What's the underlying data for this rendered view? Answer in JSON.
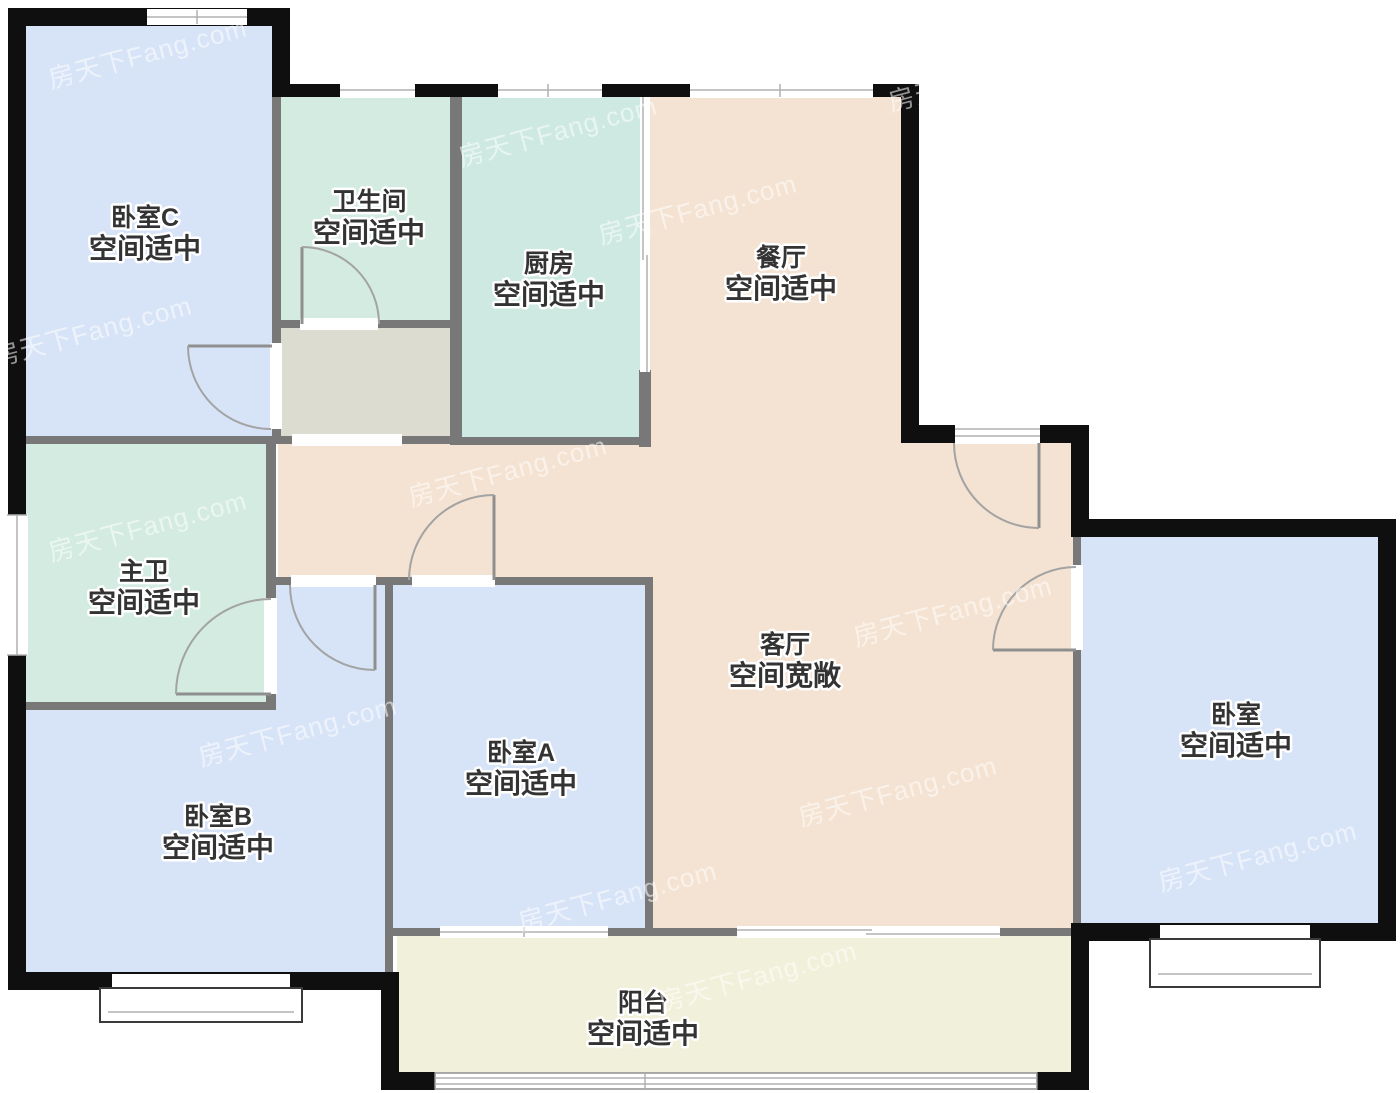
{
  "watermark": {
    "text": "房天下Fang.com"
  },
  "palette": {
    "bedroom": "#d7e4f8",
    "bathroom": "#d3ebe1",
    "kitchen": "#cde9e1",
    "living": "#f4e3d2",
    "vestibule": "#dcdcd0",
    "balcony": "#f1f0da",
    "wall_outer": "#0f0f0f",
    "wall_inner": "#787878",
    "label_color": "#333333"
  },
  "rooms": {
    "bedroom_c": {
      "name": "卧室C",
      "status": "空间适中"
    },
    "bathroom": {
      "name": "卫生间",
      "status": "空间适中"
    },
    "kitchen": {
      "name": "厨房",
      "status": "空间适中"
    },
    "dining": {
      "name": "餐厅",
      "status": "空间适中"
    },
    "master_bath": {
      "name": "主卫",
      "status": "空间适中"
    },
    "living": {
      "name": "客厅",
      "status": "空间宽敞"
    },
    "bedroom_a": {
      "name": "卧室A",
      "status": "空间适中"
    },
    "bedroom_b": {
      "name": "卧室B",
      "status": "空间适中"
    },
    "bedroom_r": {
      "name": "卧室",
      "status": "空间适中"
    },
    "balcony": {
      "name": "阳台",
      "status": "空间适中"
    }
  }
}
